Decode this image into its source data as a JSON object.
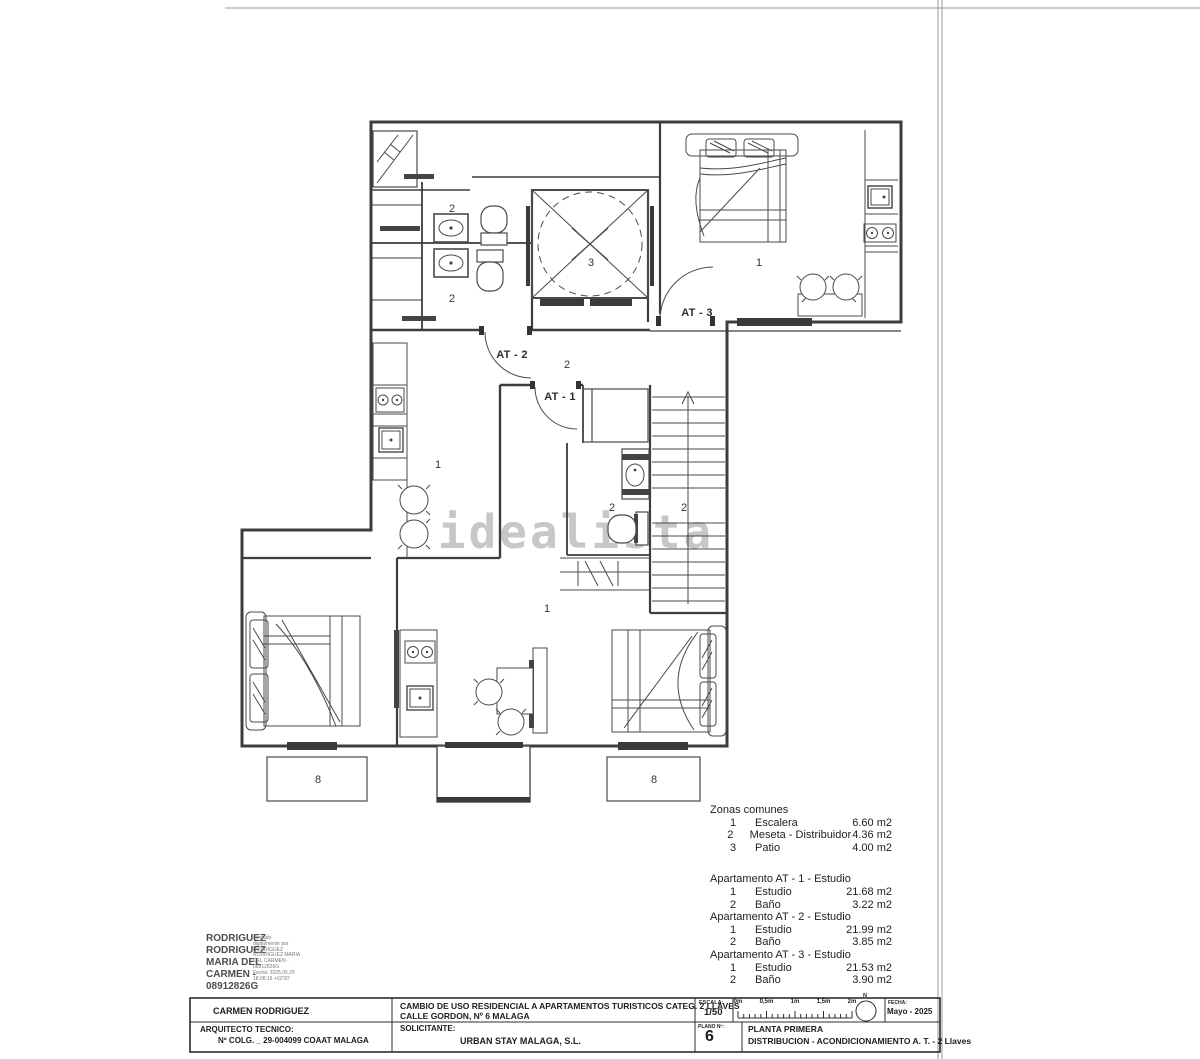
{
  "watermark": "idealista",
  "plan": {
    "labels": [
      {
        "t": "2",
        "x": 452,
        "y": 212
      },
      {
        "t": "2",
        "x": 452,
        "y": 302
      },
      {
        "t": "3",
        "x": 591,
        "y": 266
      },
      {
        "t": "1",
        "x": 759,
        "y": 266
      },
      {
        "t": "AT - 3",
        "x": 697,
        "y": 316,
        "b": 1
      },
      {
        "t": "AT - 2",
        "x": 512,
        "y": 358,
        "b": 1
      },
      {
        "t": "2",
        "x": 567,
        "y": 368
      },
      {
        "t": "AT - 1",
        "x": 560,
        "y": 400,
        "b": 1
      },
      {
        "t": "1",
        "x": 438,
        "y": 468
      },
      {
        "t": "2",
        "x": 612,
        "y": 511
      },
      {
        "t": "2",
        "x": 684,
        "y": 511
      },
      {
        "t": "1",
        "x": 547,
        "y": 612
      },
      {
        "t": "8",
        "x": 318,
        "y": 783
      },
      {
        "t": "8",
        "x": 654,
        "y": 783
      }
    ]
  },
  "schedule": {
    "blocks": [
      {
        "title": "Zonas comunes",
        "gap_after": true,
        "rows": [
          [
            "1",
            "Escalera",
            "6.60 m2"
          ],
          [
            "2",
            "Meseta - Distribuidor",
            "4.36 m2"
          ],
          [
            "3",
            "Patio",
            "4.00 m2"
          ]
        ]
      },
      {
        "title": "Apartamento AT - 1 - Estudio",
        "rows": [
          [
            "1",
            "Estudio",
            "21.68 m2"
          ],
          [
            "2",
            "Baño",
            "3.22 m2"
          ]
        ]
      },
      {
        "title": "Apartamento AT - 2 - Estudio",
        "rows": [
          [
            "1",
            "Estudio",
            "21.99 m2"
          ],
          [
            "2",
            "Baño",
            "3.85 m2"
          ]
        ]
      },
      {
        "title": "Apartamento AT - 3 - Estudio",
        "rows": [
          [
            "1",
            "Estudio",
            "21.53 m2"
          ],
          [
            "2",
            "Baño",
            "3.90 m2"
          ]
        ]
      }
    ]
  },
  "signature": {
    "name_lines": [
      "RODRIGUEZ",
      "RODRIGUEZ",
      "MARIA DEL",
      "CARMEN -",
      "08912826G"
    ],
    "stamp_lines": [
      "Firmado",
      "digitalmente por",
      "RODRIGUEZ",
      "RODRIGUEZ MARIA",
      "DEL CARMEN -",
      "08912826G",
      "Fecha: 2025.05.29",
      "18:08:16 +02'00'"
    ]
  },
  "titleblock": {
    "author": "CARMEN RODRIGUEZ",
    "project_line1": "CAMBIO DE USO RESIDENCIAL A APARTAMENTOS TURISTICOS CATEG. 2 LLAVES",
    "project_line2": "CALLE GORDON, Nº 6  MALAGA",
    "escala_label": "ESCALA:",
    "escala_value": "1/50",
    "ruler_labels": [
      "0m",
      "0,5m",
      "1m",
      "1,5m",
      "2m"
    ],
    "north_label": "N",
    "fecha_label": "FECHA:",
    "fecha_value": "Mayo - 2025",
    "plano_label": "PLANO Nº:",
    "plano_number": "6",
    "plano_line1": "PLANTA PRIMERA",
    "plano_line2": "DISTRIBUCION - ACONDICIONAMIENTO A. T. - 2 Llaves",
    "arquitecto_label": "ARQUITECTO TECNICO:",
    "arquitecto_value": "Nº COLG. _ 29-004099  COAAT MALAGA",
    "solicitante_label": "SOLICITANTE:",
    "solicitante_value": "URBAN STAY MALAGA, S.L."
  }
}
